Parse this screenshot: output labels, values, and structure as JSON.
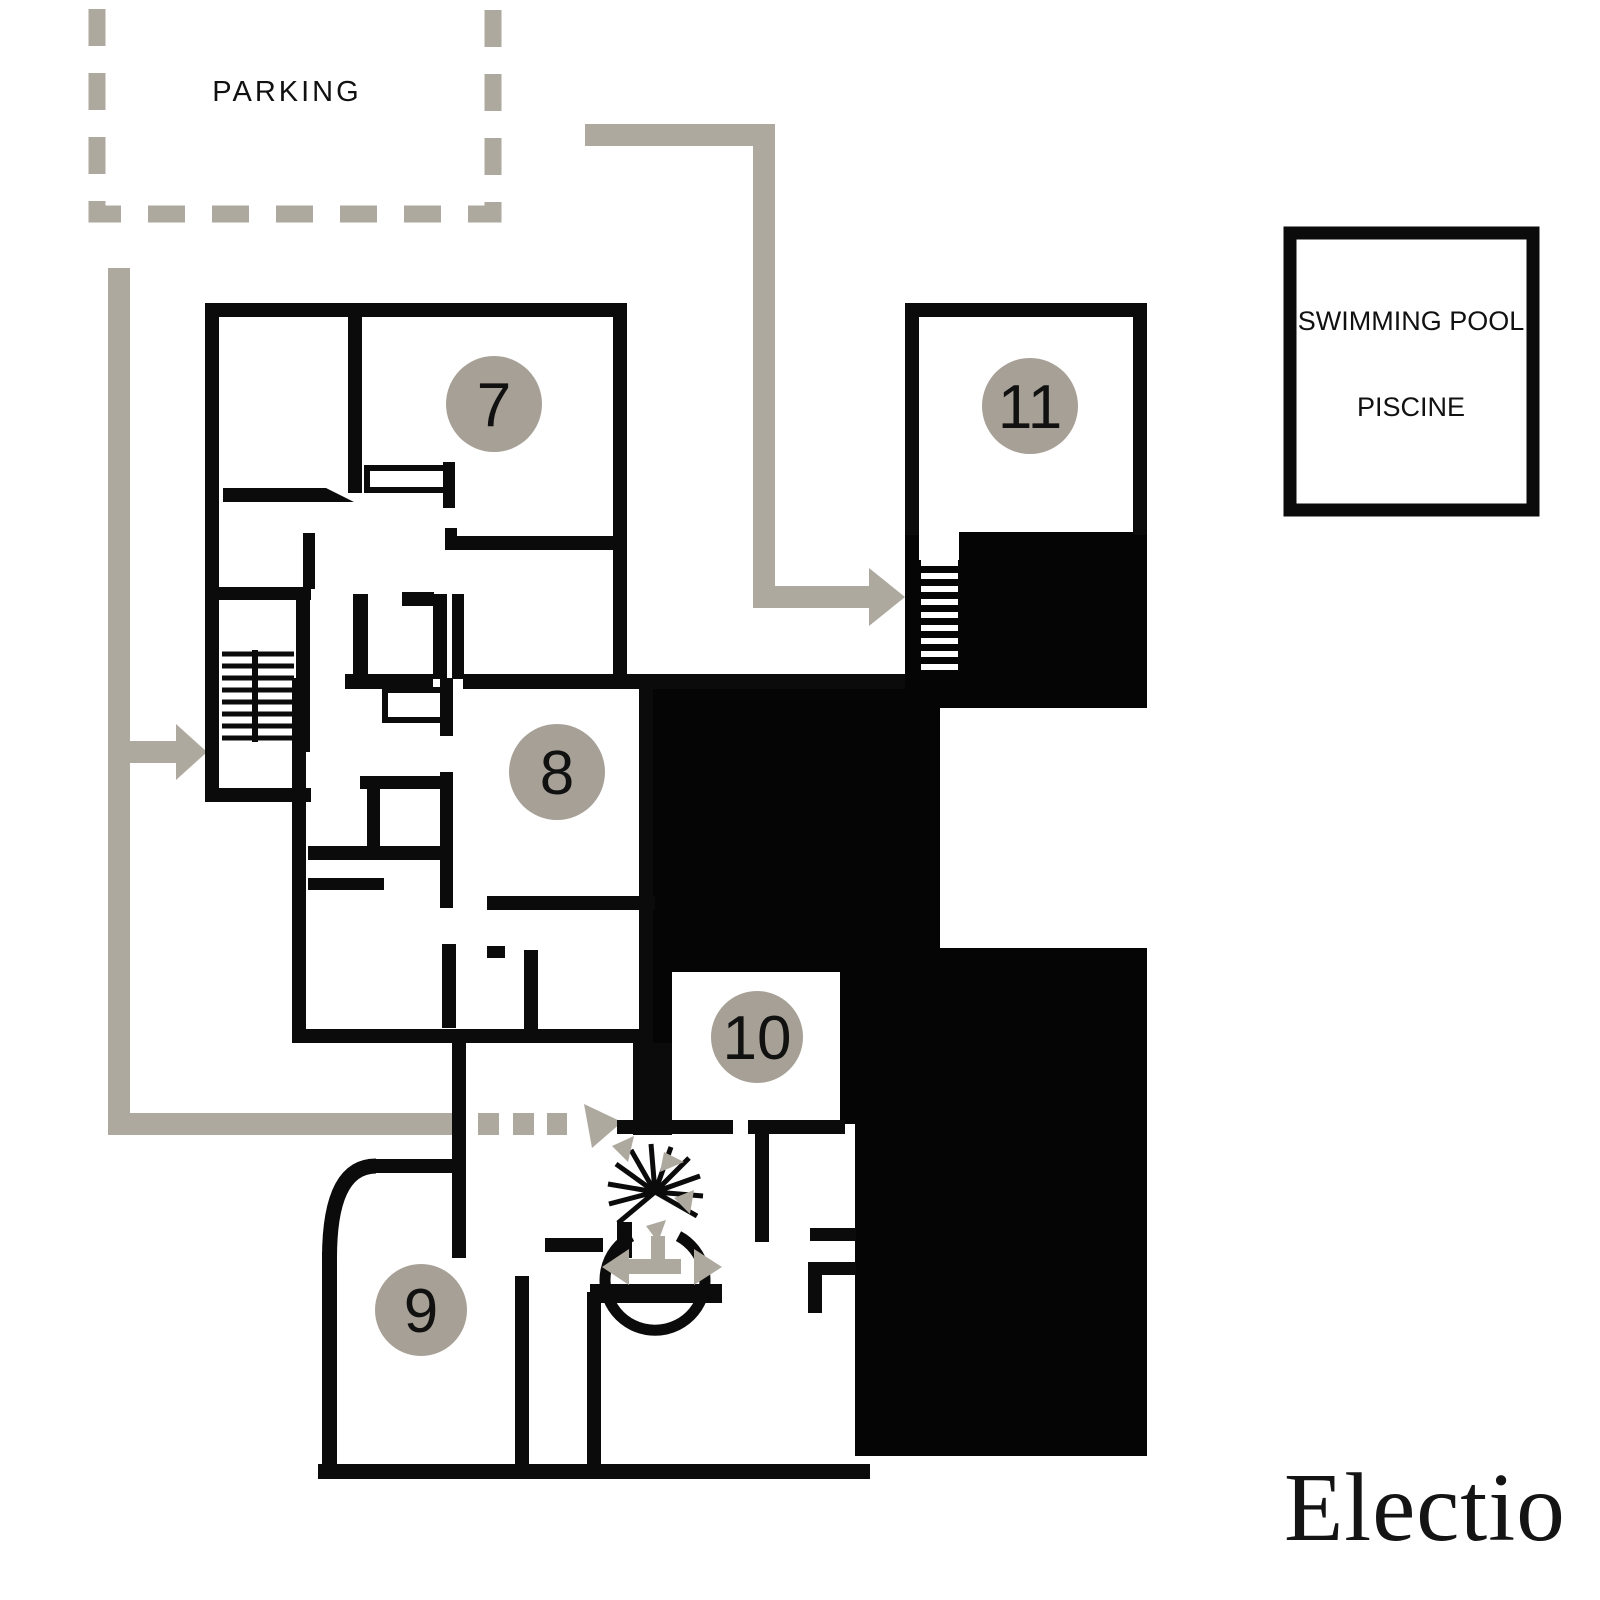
{
  "plan": {
    "type": "residence-floor-plan",
    "brand": {
      "logo": "Electio"
    },
    "parking": {
      "label": "PARKING"
    },
    "pool": {
      "line1": "SWIMMING POOL",
      "line2": "PISCINE"
    },
    "units": [
      {
        "number": "7"
      },
      {
        "number": "8"
      },
      {
        "number": "9"
      },
      {
        "number": "10"
      },
      {
        "number": "11"
      }
    ],
    "colors": {
      "walls": "#0b0b0b",
      "unit_badge": "#a7a096",
      "route": "#aea99e",
      "background": "#ffffff"
    },
    "symbols": [
      "parking-dashed-zone",
      "route-arrows",
      "straight-staircase-left",
      "straight-staircase-unit11",
      "spiral-staircase",
      "double-headed-door-arrow"
    ]
  }
}
